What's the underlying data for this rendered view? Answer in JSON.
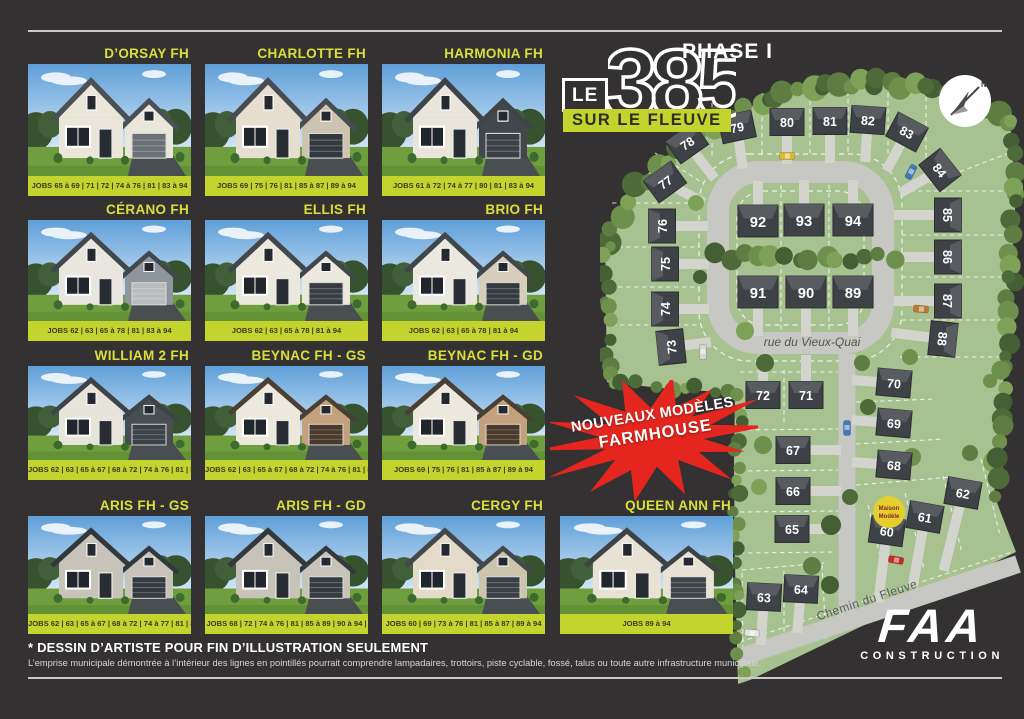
{
  "poster": {
    "phase_label": "PHASE I",
    "logo": {
      "le": "LE",
      "number": "385",
      "tagline": "SUR LE FLEUVE"
    },
    "burst": {
      "line1": "NOUVEAUX MODÈLES",
      "line2": "FARMHOUSE"
    },
    "footer": {
      "disclaimer_title": "* DESSIN D’ARTISTE POUR FIN D’ILLUSTRATION SEULEMENT",
      "disclaimer_body": "L’emprise municipale démontrée à l’intérieur des lignes en pointillés pourrait comprendre lampadaires, trottoirs, piste cyclable, fossé, talus ou toute autre infrastructure municipale."
    },
    "brand": {
      "name": "FAA",
      "sub": "CONSTRUCTION"
    }
  },
  "colors": {
    "background": "#343132",
    "accent_green": "#c3d42f",
    "title_green": "#d7e03a",
    "burst_red": "#e4261f",
    "map_grass": "#a7c190",
    "road": "#c7c7c3"
  },
  "models": [
    {
      "name": "D’ORSAY FH",
      "jobs": "JOBS 65 à 69 | 71 | 72 | 74 à 76 | 81 | 83 à 94",
      "house": {
        "body": "#eae6da",
        "accent": "#eae6da",
        "garage": "#6a7076",
        "roof": "#4b5054"
      }
    },
    {
      "name": "CHARLOTTE FH",
      "jobs": "JOBS 69 | 75 | 76 | 81 | 85 à 87 | 89 à 94",
      "house": {
        "body": "#e6dfd0",
        "accent": "#cdc4b0",
        "garage": "#33383e",
        "roof": "#474c50"
      }
    },
    {
      "name": "HARMONIA FH",
      "jobs": "JOBS 61 à 72 | 74 à 77 | 80 | 81 | 83 à 94",
      "house": {
        "body": "#e9e5da",
        "accent": "#42474d",
        "garage": "#3a3f45",
        "roof": "#3f4449"
      }
    },
    {
      "name": "CÉRANO FH",
      "jobs": "JOBS 62 | 63 | 65 à 78 | 81 | 83 à 94",
      "house": {
        "body": "#e9e6df",
        "accent": "#8f959c",
        "garage": "#b9bcbe",
        "roof": "#42474b"
      }
    },
    {
      "name": "ELLIS FH",
      "jobs": "JOBS 62 | 63 | 65 à 78 | 81 à 94",
      "house": {
        "body": "#ebe8dd",
        "accent": "#ebe8dd",
        "garage": "#383d43",
        "roof": "#42474b"
      }
    },
    {
      "name": "BRIO FH",
      "jobs": "JOBS 62 | 63 | 65 à 78 | 81 à 94",
      "house": {
        "body": "#ebe8df",
        "accent": "#d6cdbb",
        "garage": "#343a40",
        "roof": "#41464a"
      }
    },
    {
      "name": "WILLIAM 2 FH",
      "jobs": "JOBS 62 | 63 | 65 à 67 | 68 à 72 | 74 à 76 | 81 | 83 à 94",
      "house": {
        "body": "#e7e4db",
        "accent": "#484d52",
        "garage": "#3c4147",
        "roof": "#3e4347"
      }
    },
    {
      "name": "BEYNAC FH - GS",
      "jobs": "JOBS 62 | 63 | 65 à 67 | 68 à 72 | 74 à 76 | 81 | 83 à 94",
      "house": {
        "body": "#ece8dc",
        "accent": "#c2a17c",
        "garage": "#4b3a2b",
        "roof": "#4a3f35"
      }
    },
    {
      "name": "BEYNAC FH - GD",
      "jobs": "JOBS 69 | 75 | 76 | 81 | 85 à 87 | 89 à 94",
      "house": {
        "body": "#ece8dc",
        "accent": "#c2a17c",
        "garage": "#4b3a2b",
        "roof": "#4a3f35"
      }
    },
    {
      "name": "ARIS FH - GS",
      "jobs": "JOBS 62 | 63 | 65 à 67 | 68 à 72 | 74 à 77 | 81 | 83 à 94",
      "house": {
        "body": "#c8c3b9",
        "accent": "#c8c3b9",
        "garage": "#363b41",
        "roof": "#33383c"
      }
    },
    {
      "name": "ARIS FH - GD",
      "jobs": "JOBS 68 | 72 | 74 à 76 | 81 | 85 à 89 | 90 à 94 |",
      "house": {
        "body": "#c8c3b9",
        "accent": "#c8c3b9",
        "garage": "#363b41",
        "roof": "#33383c"
      }
    },
    {
      "name": "CERGY FH",
      "jobs": "JOBS 60 | 69 | 73 à 76 | 81 | 85 à 87 | 89 à 94",
      "house": {
        "body": "#e3dbc8",
        "accent": "#cdc4ae",
        "garage": "#3b4046",
        "roof": "#42474b"
      }
    },
    {
      "name": "QUEEN ANN FH",
      "jobs": "JOBS 89 à 94",
      "house": {
        "body": "#e7e2d4",
        "accent": "#e7e2d4",
        "garage": "#3f444a",
        "roof": "#3d4246"
      }
    }
  ],
  "map": {
    "street_loop": "rue du Vieux-Quai",
    "street_bottom": "Chemin du Fleuve",
    "north_label": "N",
    "badge": {
      "line1": "Maison",
      "line2": "Modèle"
    },
    "lots": [
      {
        "n": "78",
        "x": 87,
        "y": 118,
        "r": -35,
        "d": 52,
        "l": 45
      },
      {
        "n": "79",
        "x": 137,
        "y": 102,
        "r": -12,
        "d": 82,
        "l": 42
      },
      {
        "n": "80",
        "x": 187,
        "y": 97,
        "r": 0,
        "d": 90,
        "l": 42
      },
      {
        "n": "81",
        "x": 230,
        "y": 96,
        "r": 0,
        "d": 90,
        "l": 42
      },
      {
        "n": "82",
        "x": 268,
        "y": 95,
        "r": 4,
        "d": 94,
        "l": 42
      },
      {
        "n": "83",
        "x": 307,
        "y": 107,
        "r": 28,
        "d": 118,
        "l": 44
      },
      {
        "n": "84",
        "x": 340,
        "y": 145,
        "r": 52,
        "d": 150,
        "l": 46
      },
      {
        "n": "85",
        "x": 348,
        "y": 190,
        "r": 90,
        "d": 180,
        "l": 54
      },
      {
        "n": "86",
        "x": 348,
        "y": 232,
        "r": 90,
        "d": 180,
        "l": 54
      },
      {
        "n": "87",
        "x": 348,
        "y": 276,
        "r": 90,
        "d": 180,
        "l": 54
      },
      {
        "n": "88",
        "x": 343,
        "y": 314,
        "r": 96,
        "d": 187,
        "l": 52
      },
      {
        "n": "77",
        "x": 65,
        "y": 157,
        "r": -36,
        "d": 28,
        "l": 44
      },
      {
        "n": "76",
        "x": 62,
        "y": 201,
        "r": -90,
        "d": 0,
        "l": 46
      },
      {
        "n": "75",
        "x": 65,
        "y": 239,
        "r": -90,
        "d": 0,
        "l": 44
      },
      {
        "n": "74",
        "x": 65,
        "y": 284,
        "r": -90,
        "d": 0,
        "l": 44
      },
      {
        "n": "73",
        "x": 71,
        "y": 322,
        "r": -96,
        "d": -7,
        "l": 40
      },
      {
        "n": "92",
        "x": 158,
        "y": 196,
        "r": 0,
        "d": -90,
        "l": 40,
        "s": 1.18
      },
      {
        "n": "93",
        "x": 204,
        "y": 195,
        "r": 0,
        "d": -90,
        "l": 40,
        "s": 1.18
      },
      {
        "n": "94",
        "x": 253,
        "y": 195,
        "r": 0,
        "d": -90,
        "l": 40,
        "s": 1.18
      },
      {
        "n": "91",
        "x": 158,
        "y": 267,
        "r": 0,
        "d": 90,
        "l": 44,
        "s": 1.18
      },
      {
        "n": "90",
        "x": 206,
        "y": 267,
        "r": 0,
        "d": 90,
        "l": 44,
        "s": 1.18
      },
      {
        "n": "89",
        "x": 253,
        "y": 267,
        "r": 0,
        "d": 90,
        "l": 44,
        "s": 1.18
      },
      {
        "n": "72",
        "x": 163,
        "y": 370,
        "r": 0,
        "d": -90,
        "l": 40
      },
      {
        "n": "71",
        "x": 206,
        "y": 370,
        "r": 0,
        "d": -90,
        "l": 40
      },
      {
        "n": "70",
        "x": 294,
        "y": 358,
        "r": 5,
        "d": 184,
        "l": 42
      },
      {
        "n": "69",
        "x": 294,
        "y": 398,
        "r": 5,
        "d": 184,
        "l": 42
      },
      {
        "n": "68",
        "x": 294,
        "y": 440,
        "r": 5,
        "d": 184,
        "l": 42
      },
      {
        "n": "67",
        "x": 193,
        "y": 425,
        "r": 0,
        "d": 0,
        "l": 48
      },
      {
        "n": "66",
        "x": 193,
        "y": 466,
        "r": 0,
        "d": 0,
        "l": 48
      },
      {
        "n": "65",
        "x": 192,
        "y": 504,
        "r": 0,
        "d": 0,
        "l": 48
      },
      {
        "n": "63",
        "x": 164,
        "y": 572,
        "r": 3,
        "d": 94,
        "l": 48
      },
      {
        "n": "64",
        "x": 201,
        "y": 564,
        "r": 3,
        "d": 95,
        "l": 44
      },
      {
        "n": "60",
        "x": 287,
        "y": 506,
        "r": 8,
        "d": 97,
        "l": 72
      },
      {
        "n": "61",
        "x": 325,
        "y": 492,
        "r": 10,
        "d": 100,
        "l": 72
      },
      {
        "n": "62",
        "x": 363,
        "y": 468,
        "r": 10,
        "d": 104,
        "l": 80
      }
    ]
  }
}
